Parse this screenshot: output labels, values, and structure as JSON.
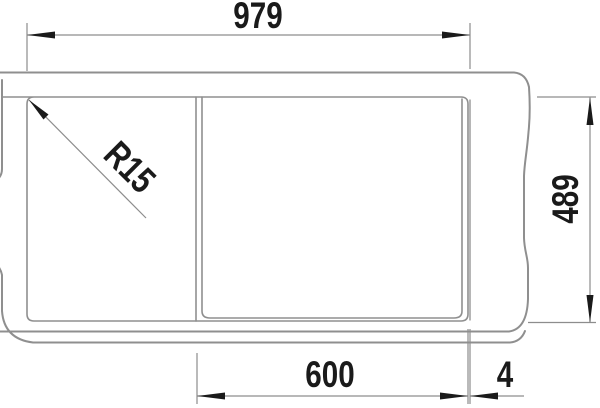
{
  "meta": {
    "type": "technical-dimension-drawing",
    "subject": "kitchen sink top view with drainboard and bowl"
  },
  "dimensions": {
    "top_width": "979",
    "right_depth": "489",
    "bottom_bowl_width": "600",
    "bottom_edge_gap": "4",
    "corner_radius": "R15"
  },
  "colors": {
    "line": "#8f8f8f",
    "dim": "#8d8d8d",
    "annotation": "#1a1a1a",
    "background": "#ffffff"
  }
}
